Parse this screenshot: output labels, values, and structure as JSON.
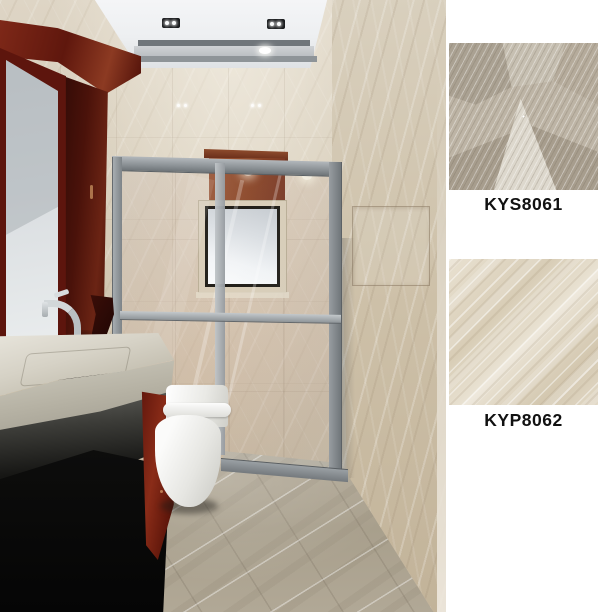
{
  "products": [
    {
      "code": "KYS8061",
      "palette": [
        "#aaa192",
        "#c6bfb1",
        "#ddd8cd",
        "#a79d8d"
      ]
    },
    {
      "code": "KYP8062",
      "palette": [
        "#e9e1d1",
        "#d8cdb6",
        "#e2d9c7"
      ]
    }
  ],
  "panel": {
    "background": "#ffffff",
    "label_color": "#111111"
  },
  "scene": {
    "palette": {
      "wall_beige": "#cfc4ae",
      "ceiling_white": "#f1f2f4",
      "ceiling_trim_gray": "#8e9498",
      "shower_frame_gray": "#8b9195",
      "wood_mahogany": "#6b1d12",
      "sink_marble": "#d6d2c6",
      "counter_dark": "#161614",
      "toilet_white": "#f4f4f2",
      "floor_greige": "#aca390",
      "glass_tint": "#d7e4eb"
    }
  }
}
